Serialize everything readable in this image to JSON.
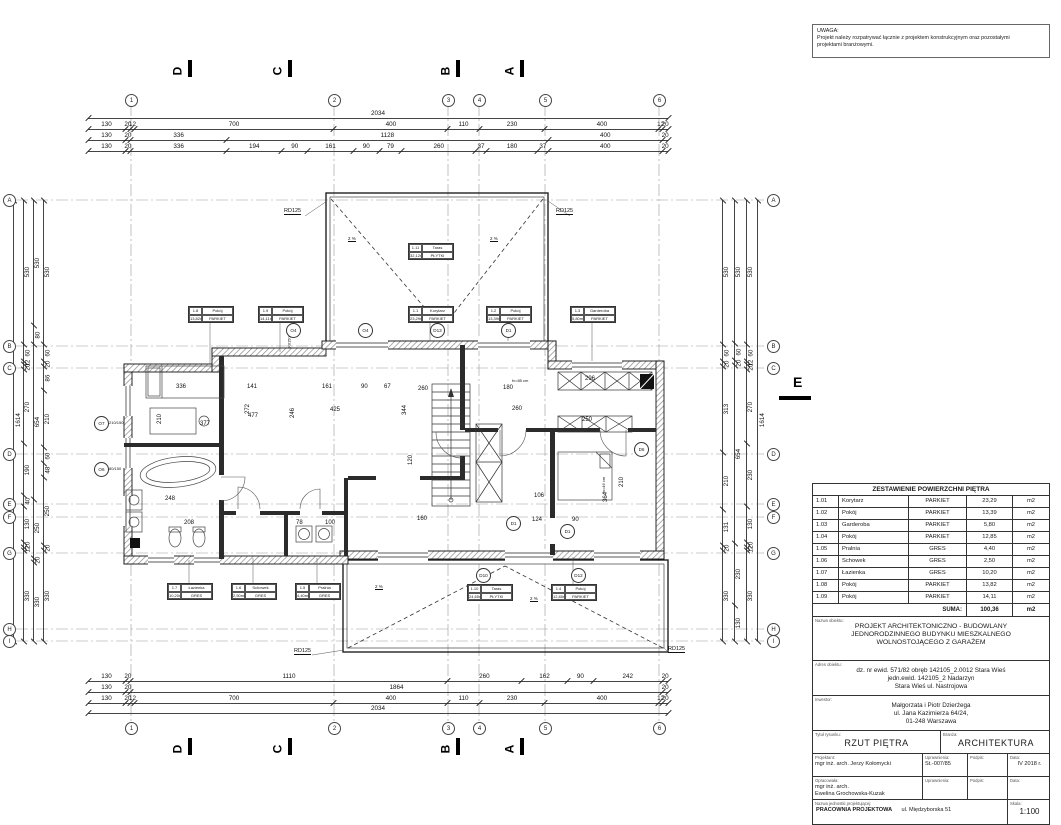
{
  "note": {
    "title": "UWAGA:",
    "line1": "Projekt należy rozpatrywać łącznie z projektem konstrukcyjnym oraz pozostałymi",
    "line2": "projektami branżowymi."
  },
  "axes": {
    "cols": [
      "1",
      "2",
      "3",
      "4",
      "5",
      "6"
    ],
    "rows": [
      "A",
      "B",
      "C",
      "D",
      "E",
      "F",
      "G",
      "H",
      "I"
    ]
  },
  "sections": {
    "s1": "D",
    "s2": "C",
    "s3": "B",
    "s4": "A",
    "right": "E"
  },
  "labels": {
    "rd": "RD125",
    "slope": "2 %"
  },
  "dims": {
    "top": {
      "overall": [
        "2034"
      ],
      "r1": [
        "130",
        "20",
        "12",
        "700",
        "400",
        "110",
        "230",
        "400",
        "12",
        "20"
      ],
      "r2": [
        "130",
        "20",
        "336",
        "1128",
        "400",
        "20"
      ],
      "r3": [
        "130",
        "20",
        "336",
        "194",
        "90",
        "161",
        "90",
        "79",
        "260",
        "37",
        "180",
        "37",
        "400",
        "20"
      ]
    },
    "bottom": {
      "r1": [
        "130",
        "20",
        "1110",
        "260",
        "162",
        "90",
        "242",
        "20"
      ],
      "r2": [
        "130",
        "20",
        "1864",
        "20"
      ],
      "r3": [
        "130",
        "20",
        "12",
        "700",
        "400",
        "110",
        "230",
        "400",
        "12",
        "20"
      ],
      "overall": [
        "2034"
      ]
    },
    "left": {
      "overall": [
        "1614"
      ],
      "outer": [
        "530",
        "60",
        "12",
        "20",
        "270",
        "190",
        "40",
        "130",
        "20",
        "12",
        "330"
      ],
      "mid": [
        "530",
        "80",
        "654",
        "250",
        "20",
        "330"
      ],
      "inner": [
        "530",
        "60",
        "20",
        "86",
        "210",
        "60",
        "48",
        "250",
        "20",
        "330"
      ]
    },
    "right": {
      "inner": [
        "530",
        "60",
        "20",
        "313",
        "210",
        "131",
        "20",
        "330"
      ],
      "mid": [
        "530",
        "60",
        "20",
        "654",
        "230",
        "130"
      ],
      "outer": [
        "530",
        "60",
        "12",
        "20",
        "270",
        "230",
        "130",
        "20",
        "12",
        "330"
      ],
      "overall": [
        "1614"
      ]
    }
  },
  "plan": {
    "tags": [
      {
        "no": "1.8",
        "name": "Pokój",
        "area": "13,82m²",
        "fin": "PARKIET"
      },
      {
        "no": "1.9",
        "name": "Pokój",
        "area": "14,11m²",
        "fin": "PARKIET"
      },
      {
        "no": "1.1",
        "name": "Korytarz",
        "area": "23,29m²",
        "fin": "PARKIET"
      },
      {
        "no": "1.2",
        "name": "Pokój",
        "area": "13,39m²",
        "fin": "PARKIET"
      },
      {
        "no": "1.3",
        "name": "Garderoba",
        "area": "5,80m²",
        "fin": "PARKIET"
      },
      {
        "no": "1.11",
        "name": "Taras",
        "area": "32,12m²",
        "fin": "PŁYTKI"
      },
      {
        "no": "1.7",
        "name": "Łazienka",
        "area": "10,20m²",
        "fin": "GRES"
      },
      {
        "no": "1.6",
        "name": "Schowek",
        "area": "2,50m²",
        "fin": "GRES"
      },
      {
        "no": "1.5",
        "name": "Pralnia",
        "area": "4,40m²",
        "fin": "GRES"
      },
      {
        "no": "1.10",
        "name": "Taras",
        "area": "24,65m²",
        "fin": "PŁYTKI"
      },
      {
        "no": "1.4",
        "name": "Pokój",
        "area": "12,85m²",
        "fin": "PARKIET"
      }
    ],
    "sym": [
      "O4",
      "O4",
      "D13",
      "D1",
      "O7",
      "O6",
      "D6",
      "D1",
      "D1",
      "D10",
      "D12"
    ],
    "win": [
      "80/150",
      "210/150",
      "80/150"
    ],
    "d": [
      "336",
      "141",
      "161",
      "90",
      "67",
      "477",
      "272",
      "246",
      "425",
      "210",
      "377",
      "260",
      "180",
      "344",
      "260",
      "120",
      "160",
      "106",
      "124",
      "90",
      "210",
      "364",
      "248",
      "208",
      "296",
      "250",
      "100",
      "78",
      "fv=85 cm",
      "fv=46 cm"
    ]
  },
  "titleblock": {
    "table": {
      "header": "ZESTAWIENIE POWIERZCHNI PIĘTRA",
      "rows": [
        {
          "no": "1.01",
          "name": "Korytarz",
          "fin": "PARKIET",
          "area": "23,29",
          "unit": "m2"
        },
        {
          "no": "1.02",
          "name": "Pokój",
          "fin": "PARKIET",
          "area": "13,39",
          "unit": "m2"
        },
        {
          "no": "1.03",
          "name": "Garderoba",
          "fin": "PARKIET",
          "area": "5,80",
          "unit": "m2"
        },
        {
          "no": "1.04",
          "name": "Pokój",
          "fin": "PARKIET",
          "area": "12,85",
          "unit": "m2"
        },
        {
          "no": "1.05",
          "name": "Pralnia",
          "fin": "GRES",
          "area": "4,40",
          "unit": "m2"
        },
        {
          "no": "1.06",
          "name": "Schowek",
          "fin": "GRES",
          "area": "2,50",
          "unit": "m2"
        },
        {
          "no": "1.07",
          "name": "Łazienka",
          "fin": "GRES",
          "area": "10,20",
          "unit": "m2"
        },
        {
          "no": "1.08",
          "name": "Pokój",
          "fin": "PARKIET",
          "area": "13,82",
          "unit": "m2"
        },
        {
          "no": "1.09",
          "name": "Pokój",
          "fin": "PARKIET",
          "area": "14,11",
          "unit": "m2"
        }
      ],
      "suma_label": "SUMA:",
      "suma": "100,36",
      "suma_unit": "m2"
    },
    "nazwa_label": "Nazwa obiektu:",
    "nazwa1": "PROJEKT ARCHITEKTONICZNO - BUDOWLANY",
    "nazwa2": "JEDNORODZINNEGO BUDYNKU MIESZKALNEGO",
    "nazwa3": "WOLNOSTOJĄCEGO Z GARAŻEM",
    "adres_label": "Adres obiektu:",
    "adres1": "dz. nr ewid. 571/82 obręb 142105_2.0012 Stara Wieś",
    "adres2": "jedn.ewid. 142105_2 Nadarzyn",
    "adres3": "Stara Wieś ul. Nastrojowa",
    "inwestor_label": "Inwestor:",
    "inwestor1": "Małgorzata i Piotr Dzierżega",
    "inwestor2": "ul. Jana Kazimierza 64/24,",
    "inwestor3": "01-248 Warszawa",
    "tytul_label": "Tytuł rysunku:",
    "tytul": "RZUT PIĘTRA",
    "branza_label": "Branża:",
    "branza": "ARCHITEKTURA",
    "projektant_label": "Projektant:",
    "projektant": "mgr inż. arch. Jerzy Kołomycki",
    "upr_label": "Uprawnienia:",
    "upr": "St.-007/85",
    "podpis_label": "Podpis:",
    "data_label": "Data:",
    "data": "IV 2018 r.",
    "oprac_label": "Opracowała:",
    "oprac1": "mgr inż. arch.",
    "oprac2": "Ewelina Grochowska-Kuzak",
    "jedn_label": "Nazwa jednostki projektującej:",
    "jedn": "PRACOWNIA PROJEKTOWA",
    "jedn2": "ul. Międzyborska 51",
    "skala_label": "Skala:",
    "skala": "1:100"
  }
}
